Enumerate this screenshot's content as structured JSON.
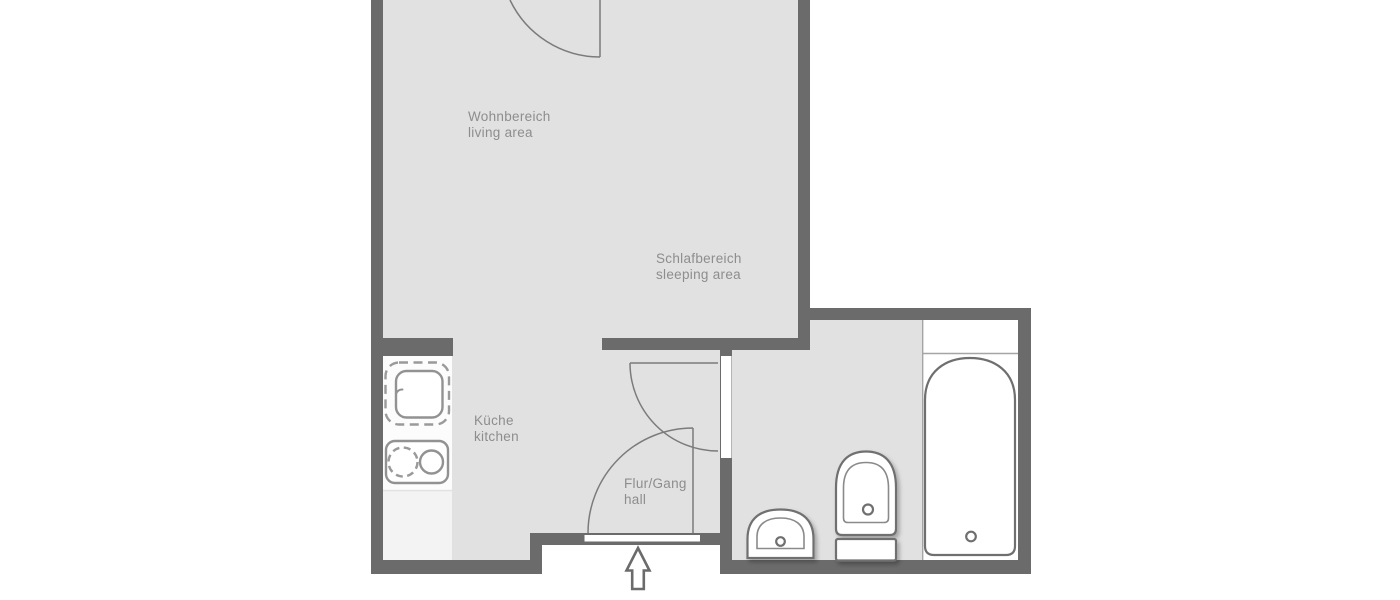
{
  "meta": {
    "type": "apartment floor plan",
    "languages": "German / English"
  },
  "colors": {
    "wall": "#6b6b6b",
    "floor": "#e1e1e1",
    "outline": "#6f6f6f",
    "thinline": "#8a8a8a",
    "doorline": "#7b7b7b",
    "text": "#8d8d8d",
    "counter": "#fcfcfc",
    "counterlower": "#f3f3f3"
  },
  "rooms": [
    {
      "id": "living",
      "name_de": "Wohnbereich",
      "name_en": "living area"
    },
    {
      "id": "sleeping",
      "name_de": "Schlafbereich",
      "name_en": "sleeping area"
    },
    {
      "id": "kitchen",
      "name_de": "Küche",
      "name_en": "kitchen"
    },
    {
      "id": "hall",
      "name_de": "Flur/Gang",
      "name_en": "hall"
    }
  ],
  "fixtures": [
    {
      "id": "kitchen-sink-icon",
      "meaning": "kitchen sink unit"
    },
    {
      "id": "stove-icon",
      "meaning": "two-burner stove"
    },
    {
      "id": "bathroom-sink-icon",
      "meaning": "wash basin"
    },
    {
      "id": "toilet-icon",
      "meaning": "toilet with cistern"
    },
    {
      "id": "bathtub-icon",
      "meaning": "bathtub on platform"
    },
    {
      "id": "door-swing-icon",
      "meaning": "door with swing arc (3x)"
    },
    {
      "id": "entrance-arrow-icon",
      "meaning": "entrance direction arrow"
    }
  ]
}
